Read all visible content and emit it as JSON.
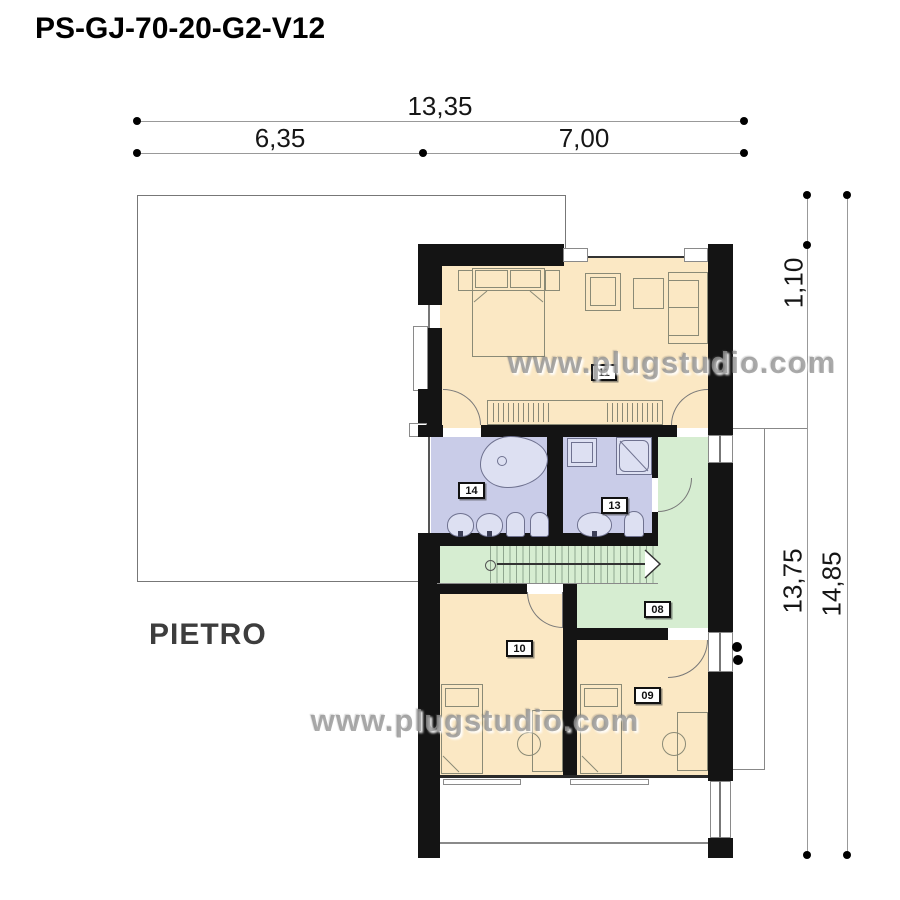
{
  "title": "PS-GJ-70-20-G2-V12",
  "floor_label": "PIETRO",
  "watermark": "www.plugstudio.com",
  "dimensions": {
    "horizontal": {
      "total": "13,35",
      "left": "6,35",
      "right": "7,00"
    },
    "vertical": {
      "offset": "1,10",
      "body": "13,75",
      "total": "14,85"
    }
  },
  "rooms": {
    "bedroom_master": {
      "number": "11"
    },
    "bathroom_large": {
      "number": "14"
    },
    "bathroom_small": {
      "number": "13"
    },
    "hallway": {
      "number": "08"
    },
    "bedroom_left": {
      "number": "10"
    },
    "bedroom_right": {
      "number": "09"
    }
  },
  "colors": {
    "room_floor": "#fbe8c4",
    "bathroom_floor": "#c9cce8",
    "hallway_floor": "#d6edd1",
    "wall": "#141414"
  }
}
